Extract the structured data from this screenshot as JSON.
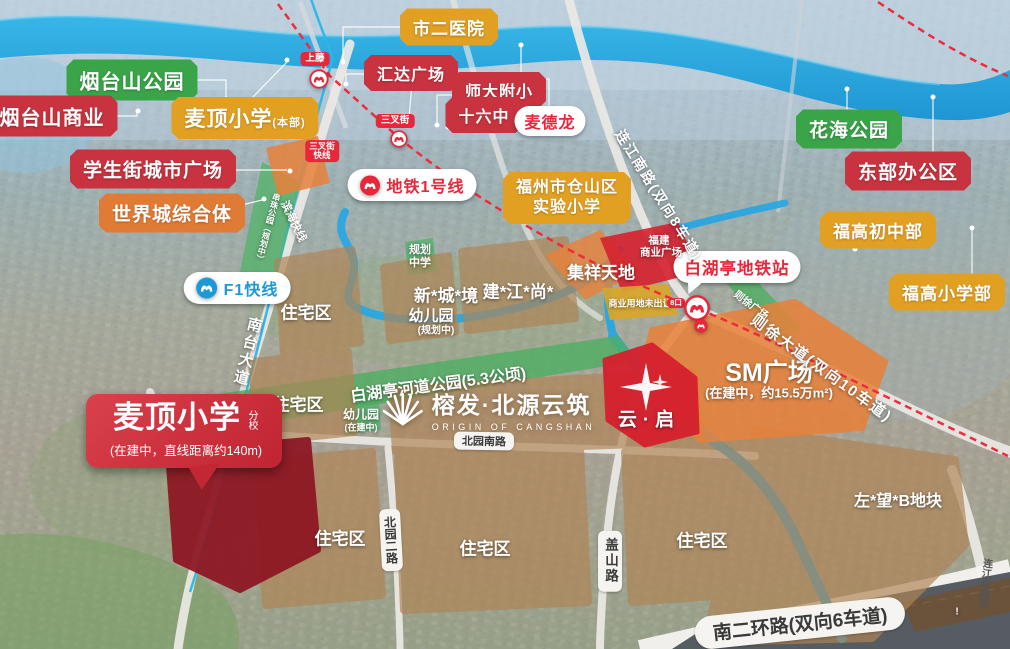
{
  "project": {
    "logo_cn": "榕发·北源云筑",
    "logo_en": "ORIGIN OF CANGSHAN"
  },
  "bubble": {
    "title": "麦顶小学",
    "branch": "分校",
    "note": "(在建中，直线距离约140m)"
  },
  "pois": {
    "yantai_park": "烟台山公园",
    "yantai_biz": "烟台山商业",
    "maiding_main": "麦顶小学",
    "maiding_main_tag": "(本部)",
    "student_street_plaza": "学生街城市广场",
    "world_city": "世界城综合体",
    "city2_hospital": "市二医院",
    "huida_plaza": "汇达广场",
    "shida_primary": "师大附小",
    "sixteen_middle": "十六中",
    "metro_mart": "麦德龙",
    "flower_sea_park": "花海公园",
    "east_office": "东部办公区",
    "fugao_junior": "福高初中部",
    "fugao_primary": "福高小学部",
    "cangshan_lab_school": [
      "福州市仓山区",
      "实验小学"
    ],
    "baihuting_station": "白湖亭地铁站",
    "sm_plaza": "SM广场",
    "sm_note": "(在建中，约15.5万m²)",
    "yunqi": "云·启",
    "jixiang": "集祥天地",
    "fujian_plaza": [
      "福建",
      "商业广场"
    ],
    "commercial_unsold": "商业用地未出让",
    "exit_badge": "8口",
    "zuowang_plot": "左*望*B地块"
  },
  "transit": {
    "line1": "地铁1号线",
    "f1": "F1快线",
    "shangteng": "上藤",
    "sanchajie": "三叉街",
    "sanchajie_express": [
      "三叉街",
      "快线"
    ],
    "binhai_express": "滨海快线"
  },
  "roads": {
    "nantai": "南台大道",
    "lianjiang_south": "连江南路(双向8车道)",
    "zexu": "则徐大道(双向10车道)",
    "beiyuan_south": "北园南路",
    "beiyuan_2": "北园二路",
    "gaishan": "盖山路",
    "ring2_south": "南二环路(双向6车道)",
    "lianjiang_elevated": "连江路高架"
  },
  "zones": {
    "residential": "住宅区",
    "xinchengjing": "新*城*境",
    "kindergarten": "幼儿园",
    "planned": "(规划中)",
    "in_construction": "(在建中)",
    "jianjiangshang": "建*江*尚*",
    "planned_school": [
      "规划",
      "中学"
    ],
    "river_park": "白湖亭河道公园(5.3公顷)",
    "zexu_plaza": "则徐广场",
    "chuanzhu_park": "串珠公园（规划中）",
    "mark": "!"
  }
}
